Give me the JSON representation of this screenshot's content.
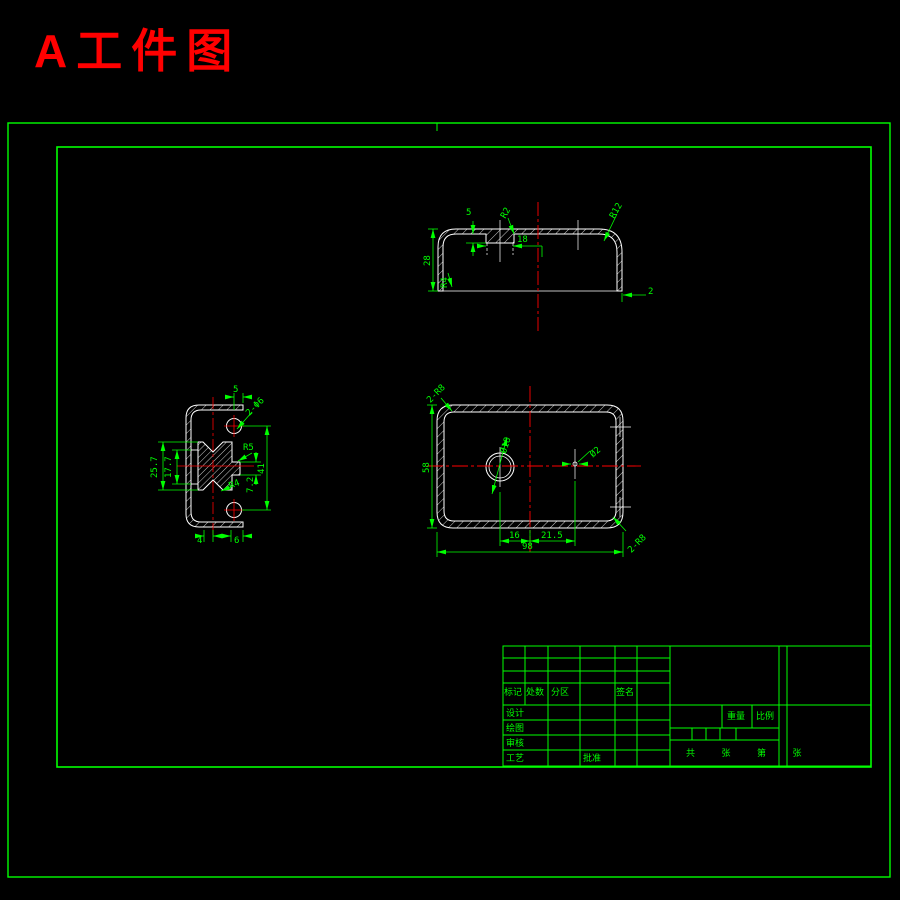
{
  "page_title": "A工件图",
  "colors": {
    "line_green": "#00ff00",
    "outline_white": "#ffffff",
    "center_red": "#ff0000",
    "title_red": "#ff0000",
    "background": "#000000"
  },
  "top_view": {
    "dim_5": "5",
    "dim_r2": "R2",
    "dim_18": "18",
    "dim_r12": "R12",
    "dim_28": "28",
    "dim_r4": "R4",
    "dim_2": "2"
  },
  "side_view": {
    "dim_5": "5",
    "dim_holes": "2-Φ6",
    "dim_257": "25.7",
    "dim_177": "17.7",
    "dim_r5": "R5",
    "dim_41": "41",
    "dim_72": "7.2",
    "dim_r4": "R4",
    "dim_4": "4",
    "dim_6": "6"
  },
  "plan_view": {
    "dim_corner_tl": "2-R8",
    "dim_corner_br": "2-R8",
    "dim_58": "58",
    "dim_d18": "Ø18",
    "dim_d2": "Ø2",
    "dim_16": "16",
    "dim_215": "21.5",
    "dim_98": "98"
  },
  "title_block": {
    "col_mark": "标记",
    "col_count": "处数",
    "col_zone": "分区",
    "col_sign": "签名",
    "row_design": "设计",
    "row_draw": "绘图",
    "row_check": "审核",
    "row_process": "工艺",
    "approve": "批准",
    "weight": "重量",
    "scale": "比例",
    "sheet": "共 张 第 张"
  }
}
